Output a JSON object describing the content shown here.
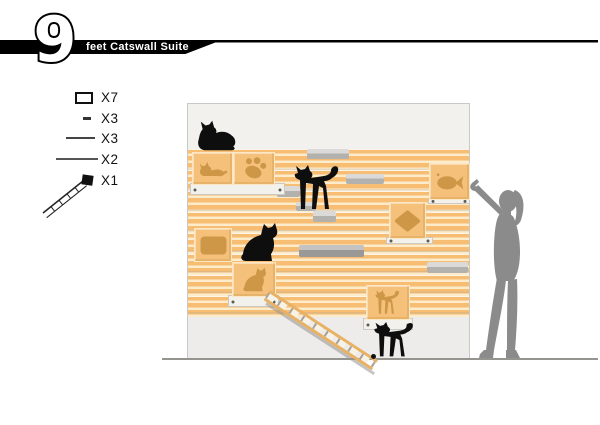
{
  "header": {
    "big_number": "9",
    "title": "feet Catswall Suite"
  },
  "legend": {
    "items": [
      {
        "icon": "cube-box-icon",
        "label": "X7"
      },
      {
        "icon": "small-shelf-icon",
        "label": "X3"
      },
      {
        "icon": "medium-shelf-icon",
        "label": "X3"
      },
      {
        "icon": "long-shelf-icon",
        "label": "X2"
      },
      {
        "icon": "ladder-icon",
        "label": "X1"
      }
    ]
  },
  "scene": {
    "wall_colors": {
      "stripe_orange": "#f6bd73",
      "stripe_cream": "#fdeccb",
      "top_panel": "#f2f1ee",
      "bottom_panel": "#edecea",
      "border": "#c9c9c9"
    },
    "box_face_color": "#f4c07a",
    "cutout_color": "#cd9747",
    "shelf_color": "#b3b1ae",
    "cat_color": "#0e0e0e",
    "figure_color": "#8b8b8b",
    "cutout_shapes": [
      "lying-cat",
      "paw-print",
      "fish",
      "diamond",
      "rounded-rectangle",
      "sitting-cat",
      "walking-cat"
    ]
  }
}
